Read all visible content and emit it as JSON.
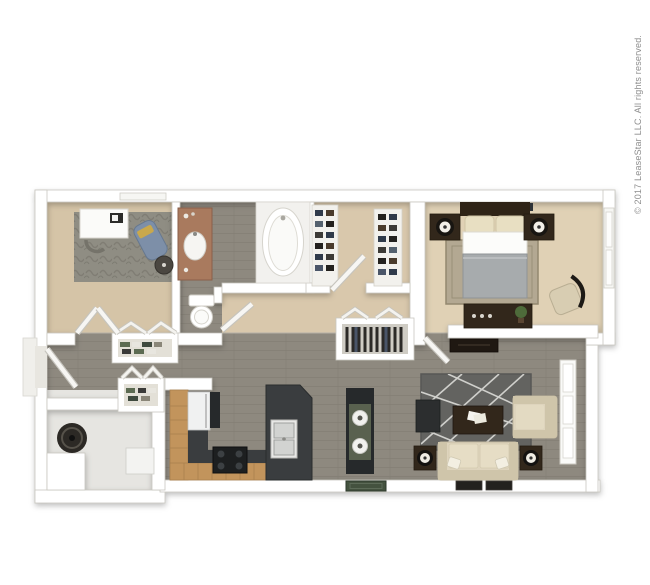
{
  "copyright": "© 2017 LeaseStar LLC. All rights reserved.",
  "plan": {
    "type": "3d-apartment-floor-plan",
    "rooms": [
      "office-den",
      "bathroom",
      "walk-in-closet",
      "bedroom",
      "hallway",
      "kitchen",
      "living-room",
      "utility-room",
      "entry"
    ]
  },
  "palette": {
    "background": "#ffffff",
    "wall": "#ffffff",
    "wood_floor": "#8e897f",
    "carpet_office": "#d5c4a7",
    "carpet_closet": "#d9c8ac",
    "carpet_bedroom": "#e0d1b5",
    "utility_floor": "#e6e5e1",
    "office_rug": "#8f8d83",
    "living_rug": "#636360",
    "bedroom_rug": "#b3a892",
    "counter_dark": "#3a3d3f",
    "cabinet_dark": "#26292b",
    "bar_wood": "#c2945c",
    "furniture_dark": "#32271b",
    "sofa_cream": "#ded4bd",
    "granite_vanity": "#a97a5e",
    "chaise_blue": "#7d8fa8",
    "bedding_gray": "#a7abad",
    "water_heater": "#2c2925",
    "mat_green": "#44523f",
    "copyright_color": "#8e8e8e"
  }
}
